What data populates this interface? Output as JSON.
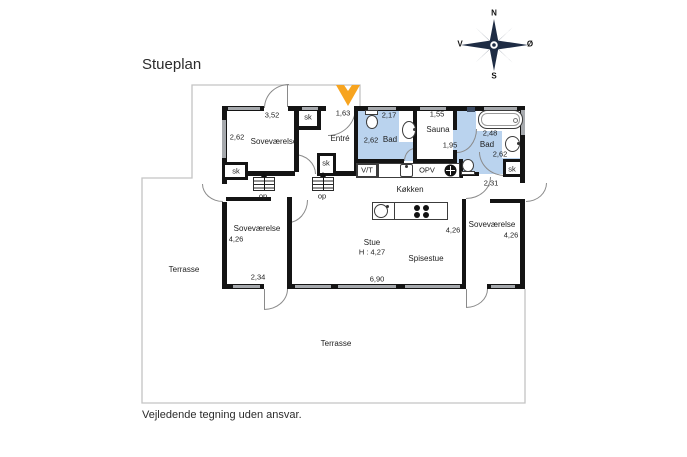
{
  "title": "Stueplan",
  "footer": "Vejledende tegning uden ansvar.",
  "compass": {
    "n": "N",
    "s": "S",
    "w": "V",
    "e": "Ø"
  },
  "labels": {
    "closet": "sk",
    "stairs_up": "op",
    "washer_dryer": "V/T",
    "dishwasher": "OPV"
  },
  "rooms": {
    "bedroom1": {
      "name": "Soveværelse",
      "w": "3,52",
      "d": "2,62"
    },
    "entry": {
      "name": "Entré",
      "w": "1,63"
    },
    "bath1": {
      "name": "Bad",
      "w": "2,17",
      "d": "2,62"
    },
    "sauna": {
      "name": "Sauna",
      "w": "1,55",
      "d": "1,95"
    },
    "bath2": {
      "name": "Bad",
      "w": "2,48",
      "d": "2,62"
    },
    "hall": {
      "w": "2,31"
    },
    "kitchen": {
      "name": "Køkken"
    },
    "living": {
      "name": "Stue",
      "ceiling": "H : 4,27",
      "w": "6,90"
    },
    "dining": {
      "name": "Spisestue",
      "d": "4,26"
    },
    "bedroom2": {
      "name": "Soveværelse",
      "d": "4,26",
      "w": "2,34"
    },
    "bedroom3": {
      "name": "Soveværelse",
      "d": "4,26"
    },
    "terrace_side": {
      "name": "Terrasse"
    },
    "terrace_main": {
      "name": "Terrasse"
    }
  },
  "colors": {
    "bath_fill": "#BAD3EE",
    "entrance_arrow": "#F7A41F",
    "compass": "#1E2C44",
    "wall": "#141414",
    "window": "#A6A9AD",
    "terrace_line": "#C4C4C4"
  },
  "icons": {
    "entrance": "orange-chevron-down-arrow",
    "compass": "compass-rose"
  }
}
